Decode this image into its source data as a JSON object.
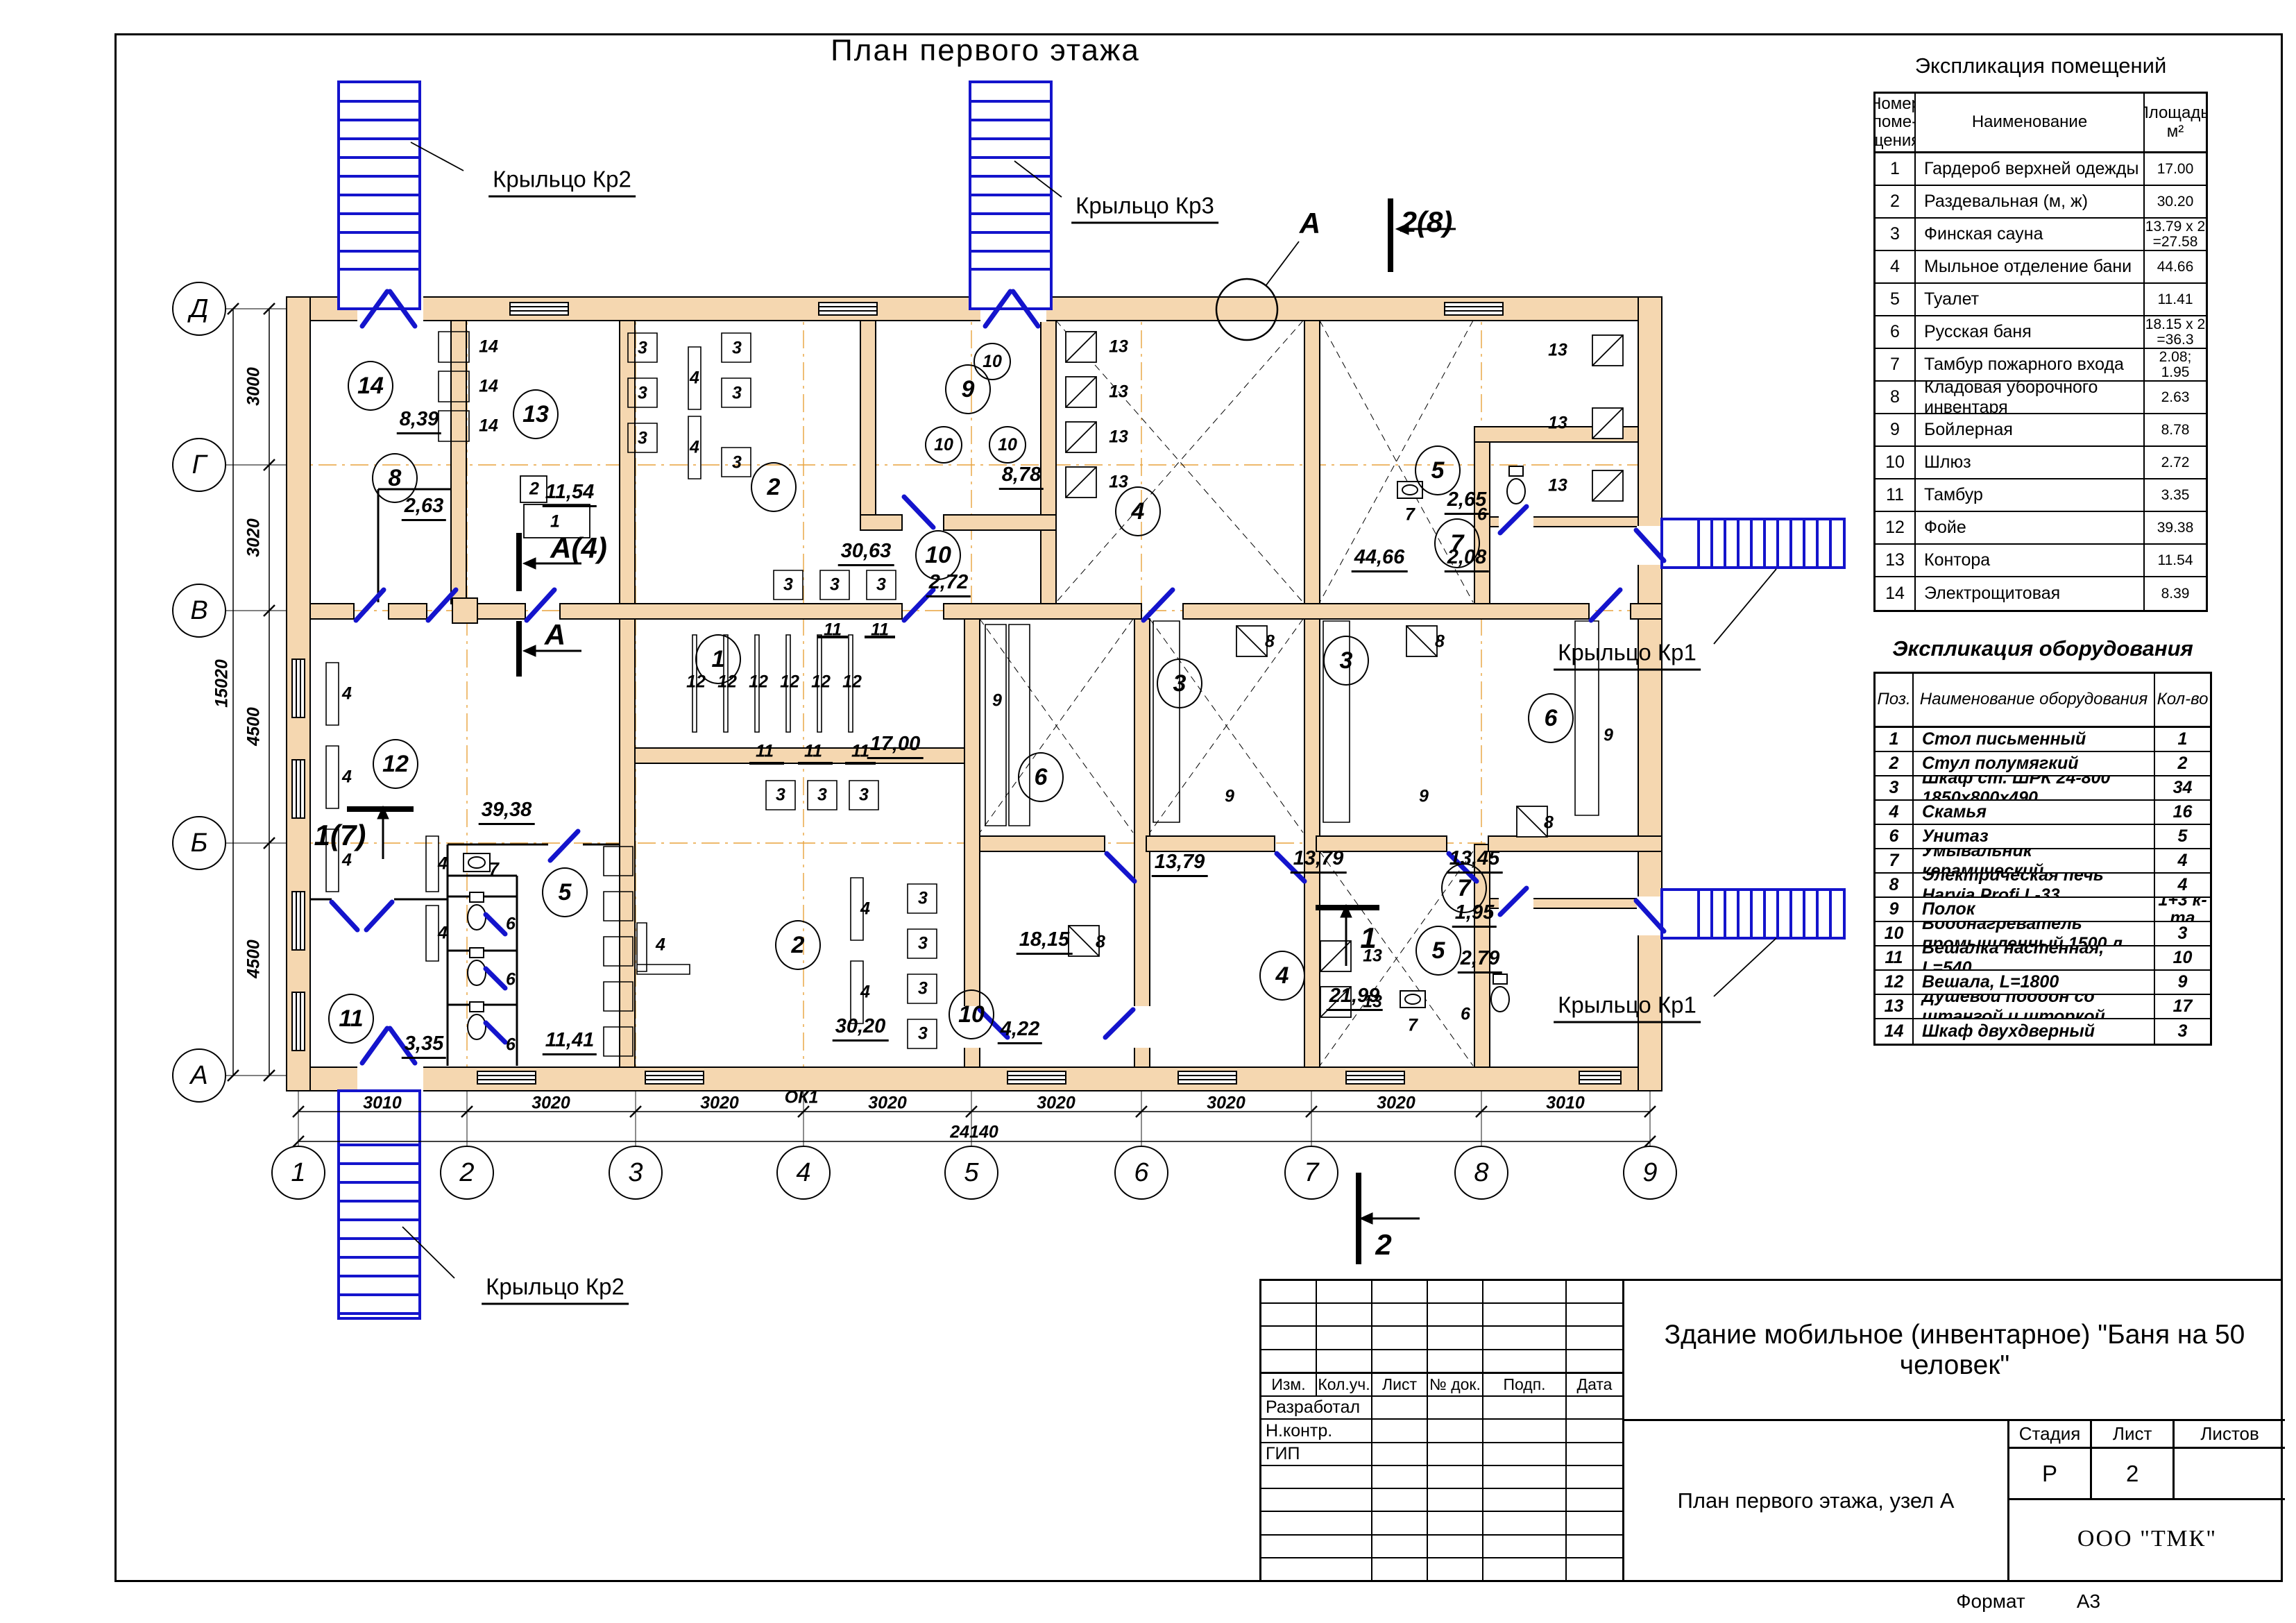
{
  "plan": {
    "title": "План первого этажа",
    "labels": [
      [
        "ptitle",
        1420,
        73,
        "План первого этажа"
      ],
      [
        "ax",
        430,
        1690,
        "1"
      ],
      [
        "ax",
        673,
        1690,
        "2"
      ],
      [
        "ax",
        916,
        1690,
        "3"
      ],
      [
        "ax",
        1158,
        1690,
        "4"
      ],
      [
        "ax",
        1400,
        1690,
        "5"
      ],
      [
        "ax",
        1645,
        1690,
        "6"
      ],
      [
        "ax",
        1890,
        1690,
        "7"
      ],
      [
        "ax",
        2135,
        1690,
        "8"
      ],
      [
        "ax",
        2378,
        1690,
        "9"
      ],
      [
        "ax",
        287,
        445,
        "Д"
      ],
      [
        "ax",
        287,
        670,
        "Г"
      ],
      [
        "ax",
        287,
        880,
        "В"
      ],
      [
        "ax",
        287,
        1215,
        "Б"
      ],
      [
        "ax",
        287,
        1550,
        "А"
      ],
      [
        "dim",
        551,
        1590,
        "3010"
      ],
      [
        "dim",
        794,
        1590,
        "3020"
      ],
      [
        "dim",
        1037,
        1590,
        "3020"
      ],
      [
        "dim",
        1279,
        1590,
        "3020"
      ],
      [
        "dim",
        1522,
        1590,
        "3020"
      ],
      [
        "dim",
        1767,
        1590,
        "3020"
      ],
      [
        "dim",
        2012,
        1590,
        "3020"
      ],
      [
        "dim",
        2256,
        1590,
        "3010"
      ],
      [
        "dim",
        1404,
        1632,
        "24140"
      ],
      [
        "vdim",
        366,
        557,
        "3000"
      ],
      [
        "vdim",
        366,
        775,
        "3020"
      ],
      [
        "vdim",
        366,
        1047,
        "4500"
      ],
      [
        "vdim",
        366,
        1382,
        "4500"
      ],
      [
        "vdim",
        320,
        985,
        "15020"
      ],
      [
        "lead",
        810,
        262,
        "Крыльцо Кр2"
      ],
      [
        "lead",
        1650,
        300,
        "Крыльцо Кр3"
      ],
      [
        "lead",
        2345,
        944,
        "Крыльцо Кр1"
      ],
      [
        "lead",
        2345,
        1452,
        "Крыльцо Кр1"
      ],
      [
        "lead",
        800,
        1858,
        "Крыльцо Кр2"
      ],
      [
        "sec",
        1888,
        322,
        "А"
      ],
      [
        "sec",
        2056,
        320,
        "2(8)"
      ],
      [
        "sec",
        834,
        790,
        "А(4)"
      ],
      [
        "sec",
        800,
        915,
        "А"
      ],
      [
        "sec",
        490,
        1204,
        "1(7)"
      ],
      [
        "sec",
        1972,
        1352,
        "1"
      ],
      [
        "sec",
        1994,
        1794,
        "2"
      ],
      [
        "adim",
        604,
        607,
        "8,39"
      ],
      [
        "adim",
        611,
        732,
        "2,63"
      ],
      [
        "adim",
        821,
        712,
        "11,54"
      ],
      [
        "adim",
        1248,
        797,
        "30,63"
      ],
      [
        "adim",
        1367,
        842,
        "2,72"
      ],
      [
        "adim",
        1472,
        687,
        "8,78"
      ],
      [
        "adim",
        1988,
        806,
        "44,66"
      ],
      [
        "adim",
        2114,
        723,
        "2,65"
      ],
      [
        "adim",
        2114,
        806,
        "2,08"
      ],
      [
        "adim",
        730,
        1170,
        "39,38"
      ],
      [
        "adim",
        1290,
        1075,
        "17,00"
      ],
      [
        "adim",
        611,
        1507,
        "3,35"
      ],
      [
        "adim",
        821,
        1502,
        "11,41"
      ],
      [
        "adim",
        1240,
        1482,
        "30,20"
      ],
      [
        "adim",
        1470,
        1486,
        "4,22"
      ],
      [
        "adim",
        1505,
        1357,
        "18,15"
      ],
      [
        "adim",
        1700,
        1245,
        "13,79"
      ],
      [
        "adim",
        1900,
        1240,
        "13,79"
      ],
      [
        "adim",
        2125,
        1240,
        "13,45"
      ],
      [
        "adim",
        1952,
        1438,
        "21,99"
      ],
      [
        "adim",
        2133,
        1384,
        "2,79"
      ],
      [
        "adim",
        2125,
        1318,
        "1,95"
      ],
      [
        "room",
        534,
        556,
        "14"
      ],
      [
        "room",
        772,
        597,
        "13"
      ],
      [
        "room",
        569,
        689,
        "8"
      ],
      [
        "room",
        1115,
        702,
        "2"
      ],
      [
        "room",
        1395,
        561,
        "9"
      ],
      [
        "room",
        1352,
        800,
        "10"
      ],
      [
        "room",
        1640,
        737,
        "4"
      ],
      [
        "room",
        2072,
        678,
        "5"
      ],
      [
        "room",
        2100,
        783,
        "7"
      ],
      [
        "room",
        570,
        1101,
        "12"
      ],
      [
        "room",
        506,
        1468,
        "11"
      ],
      [
        "room",
        814,
        1286,
        "5"
      ],
      [
        "room",
        1150,
        1362,
        "2"
      ],
      [
        "room",
        1500,
        1120,
        "6"
      ],
      [
        "room",
        1400,
        1462,
        "10"
      ],
      [
        "room",
        1700,
        985,
        "3"
      ],
      [
        "room",
        1940,
        952,
        "3"
      ],
      [
        "room",
        2235,
        1035,
        "6"
      ],
      [
        "room",
        1035,
        950,
        "1"
      ],
      [
        "room",
        1848,
        1406,
        "4"
      ],
      [
        "room",
        2073,
        1370,
        "5"
      ],
      [
        "room",
        2110,
        1280,
        "7"
      ],
      [
        "ecirc",
        1430,
        521,
        "10"
      ],
      [
        "ecirc",
        1360,
        641,
        "10"
      ],
      [
        "ecirc",
        1452,
        641,
        "10"
      ],
      [
        "eq",
        704,
        500,
        "14"
      ],
      [
        "eq",
        704,
        557,
        "14"
      ],
      [
        "eq",
        704,
        614,
        "14"
      ],
      [
        "eq",
        800,
        752,
        "1"
      ],
      [
        "eq",
        770,
        705,
        "2"
      ],
      [
        "eq",
        926,
        502,
        "3"
      ],
      [
        "eq",
        926,
        567,
        "3"
      ],
      [
        "eq",
        926,
        632,
        "3"
      ],
      [
        "eq",
        1062,
        502,
        "3"
      ],
      [
        "eq",
        1062,
        567,
        "3"
      ],
      [
        "eq",
        1062,
        667,
        "3"
      ],
      [
        "eq",
        1001,
        545,
        "4"
      ],
      [
        "eq",
        1001,
        645,
        "4"
      ],
      [
        "eq",
        1136,
        843,
        "3"
      ],
      [
        "eq",
        1203,
        843,
        "3"
      ],
      [
        "eq",
        1270,
        843,
        "3"
      ],
      [
        "eq",
        1612,
        500,
        "13"
      ],
      [
        "eq",
        1612,
        565,
        "13"
      ],
      [
        "eq",
        1612,
        630,
        "13"
      ],
      [
        "eq",
        1612,
        695,
        "13"
      ],
      [
        "eq",
        2245,
        505,
        "13"
      ],
      [
        "eq",
        2245,
        610,
        "13"
      ],
      [
        "eq",
        2245,
        700,
        "13"
      ],
      [
        "eq",
        1003,
        983,
        "12"
      ],
      [
        "eq",
        1048,
        983,
        "12"
      ],
      [
        "eq",
        1093,
        983,
        "12"
      ],
      [
        "eq",
        1138,
        983,
        "12"
      ],
      [
        "eq",
        1183,
        983,
        "12"
      ],
      [
        "eq",
        1228,
        983,
        "12"
      ],
      [
        "eq",
        1200,
        908,
        "11"
      ],
      [
        "eq",
        1268,
        908,
        "11"
      ],
      [
        "eq",
        1102,
        1083,
        "11"
      ],
      [
        "eq",
        1172,
        1083,
        "11"
      ],
      [
        "eq",
        1240,
        1083,
        "11"
      ],
      [
        "eq",
        1125,
        1146,
        "3"
      ],
      [
        "eq",
        1185,
        1146,
        "3"
      ],
      [
        "eq",
        1245,
        1146,
        "3"
      ],
      [
        "eq",
        500,
        1000,
        "4"
      ],
      [
        "eq",
        500,
        1120,
        "4"
      ],
      [
        "eq",
        500,
        1240,
        "4"
      ],
      [
        "eq",
        638,
        1245,
        "4"
      ],
      [
        "eq",
        638,
        1345,
        "4"
      ],
      [
        "eq",
        952,
        1362,
        "4"
      ],
      [
        "eq",
        712,
        1253,
        "7"
      ],
      [
        "eq",
        736,
        1332,
        "6"
      ],
      [
        "eq",
        736,
        1412,
        "6"
      ],
      [
        "eq",
        736,
        1506,
        "6"
      ],
      [
        "eq",
        1330,
        1295,
        "3"
      ],
      [
        "eq",
        1330,
        1360,
        "3"
      ],
      [
        "eq",
        1330,
        1425,
        "3"
      ],
      [
        "eq",
        1330,
        1490,
        "3"
      ],
      [
        "eq",
        1247,
        1310,
        "4"
      ],
      [
        "eq",
        1247,
        1430,
        "4"
      ],
      [
        "eq",
        1437,
        1010,
        "9"
      ],
      [
        "eq",
        1772,
        1148,
        "9"
      ],
      [
        "eq",
        2052,
        1148,
        "9"
      ],
      [
        "eq",
        2318,
        1060,
        "9"
      ],
      [
        "eq",
        1586,
        1358,
        "8"
      ],
      [
        "eq",
        1830,
        925,
        "8"
      ],
      [
        "eq",
        2075,
        925,
        "8"
      ],
      [
        "eq",
        2232,
        1186,
        "8"
      ],
      [
        "eq",
        2032,
        742,
        "7"
      ],
      [
        "eq",
        2136,
        742,
        "6"
      ],
      [
        "eq",
        2036,
        1478,
        "7"
      ],
      [
        "eq",
        2112,
        1462,
        "6"
      ],
      [
        "eq",
        1978,
        1378,
        "13"
      ],
      [
        "eq",
        1978,
        1444,
        "13"
      ],
      [
        "eq",
        1155,
        1582,
        "ОК1"
      ]
    ]
  },
  "rooms_table": {
    "title": "Экспликация помещений",
    "col_headers": [
      "Номер\nпоме-\nщения",
      "Наименование",
      "Площадь,\nм²"
    ],
    "rows": [
      [
        "1",
        "Гардероб верхней одежды",
        "17.00"
      ],
      [
        "2",
        "Раздевальная (м, ж)",
        "30.20"
      ],
      [
        "3",
        "Финская сауна",
        "13.79 х 2\n=27.58"
      ],
      [
        "4",
        "Мыльное отделение бани",
        "44.66"
      ],
      [
        "5",
        "Туалет",
        "11.41"
      ],
      [
        "6",
        "Русская баня",
        "18.15 х 2 =36.3"
      ],
      [
        "7",
        "Тамбур пожарного входа",
        "2.08; 1.95"
      ],
      [
        "8",
        "Кладовая уборочного инвентаря",
        "2.63"
      ],
      [
        "9",
        "Бойлерная",
        "8.78"
      ],
      [
        "10",
        "Шлюз",
        "2.72"
      ],
      [
        "11",
        "Тамбур",
        "3.35"
      ],
      [
        "12",
        "Фойе",
        "39.38"
      ],
      [
        "13",
        "Контора",
        "11.54"
      ],
      [
        "14",
        "Электрощитовая",
        "8.39"
      ]
    ]
  },
  "equipment_table": {
    "title": "Экспликация оборудования",
    "col_headers": [
      "Поз.",
      "Наименование оборудования",
      "Кол-во"
    ],
    "rows": [
      [
        "1",
        "Стол письменный",
        "1"
      ],
      [
        "2",
        "Стул полумягкий",
        "2"
      ],
      [
        "3",
        "Шкаф ст. ШРК 24-800 1850х800х490",
        "34"
      ],
      [
        "4",
        "Скамья",
        "16"
      ],
      [
        "6",
        "Унитаз",
        "5"
      ],
      [
        "7",
        "Умывальник керамический",
        "4"
      ],
      [
        "8",
        "Электрическая печь Harvia Profi L-33",
        "4"
      ],
      [
        "9",
        "Полок",
        "1+3 к-та"
      ],
      [
        "10",
        "Водонагреватель промышленный 1500 л.",
        "3"
      ],
      [
        "11",
        "Вешалка настенная, L=540",
        "10"
      ],
      [
        "12",
        "Вешала, L=1800",
        "9"
      ],
      [
        "13",
        "Душевой поддон со штангой и шторкой",
        "17"
      ],
      [
        "14",
        "Шкаф двухдверный",
        "3"
      ]
    ]
  },
  "title_block": {
    "cols": [
      "Изм.",
      "Кол.уч.",
      "Лист",
      "№ док.",
      "Подп.",
      "Дата"
    ],
    "row_labels": [
      "Разработал",
      "Н.контр.",
      "ГИП"
    ],
    "doc_title": "Здание мобильное (инвентарное) \"Баня на 50 человек\"",
    "sheet_caption": "План первого этажа, узел А",
    "stage_label": "Стадия",
    "sheet_label": "Лист",
    "sheets_label": "Листов",
    "stage": "Р",
    "sheet_num": "2",
    "sheets": "",
    "org": "ООО \"ТМК\"",
    "format_label": "Формат",
    "format": "А3"
  }
}
